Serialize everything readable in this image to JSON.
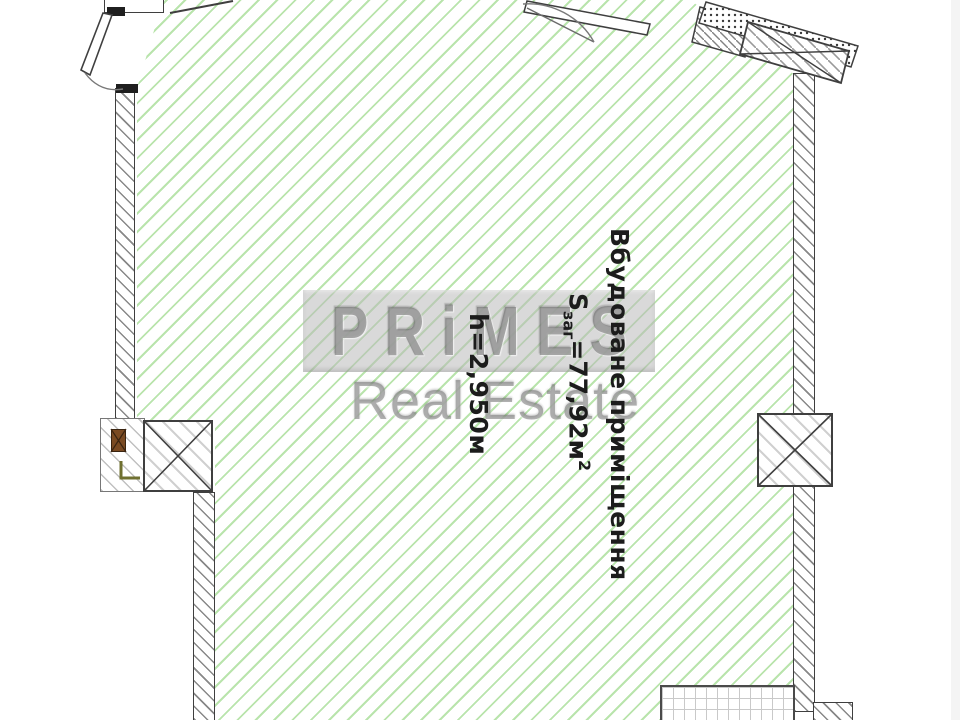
{
  "palette": {
    "floor_hatch_green": "#b9e4ac",
    "wall_line": "#3f3f3f",
    "wall_hatch_gray": "#8c8c8c",
    "watermark_gray": "#8f8f8f",
    "annotation_black": "#1c1c1c",
    "wood_brown": "#7a4a22",
    "frame_olive": "#6f7030"
  },
  "annotations": {
    "room_name": "Вбудоване приміщення",
    "area": {
      "symbol": "S",
      "subscript": "заг",
      "value": "=77,92м",
      "superscript": "2"
    },
    "height": "h=2,950м"
  },
  "watermark": {
    "brand_letters": [
      "P",
      "R",
      "i",
      "M",
      "E",
      "S"
    ],
    "tagline": "Real Estate"
  }
}
